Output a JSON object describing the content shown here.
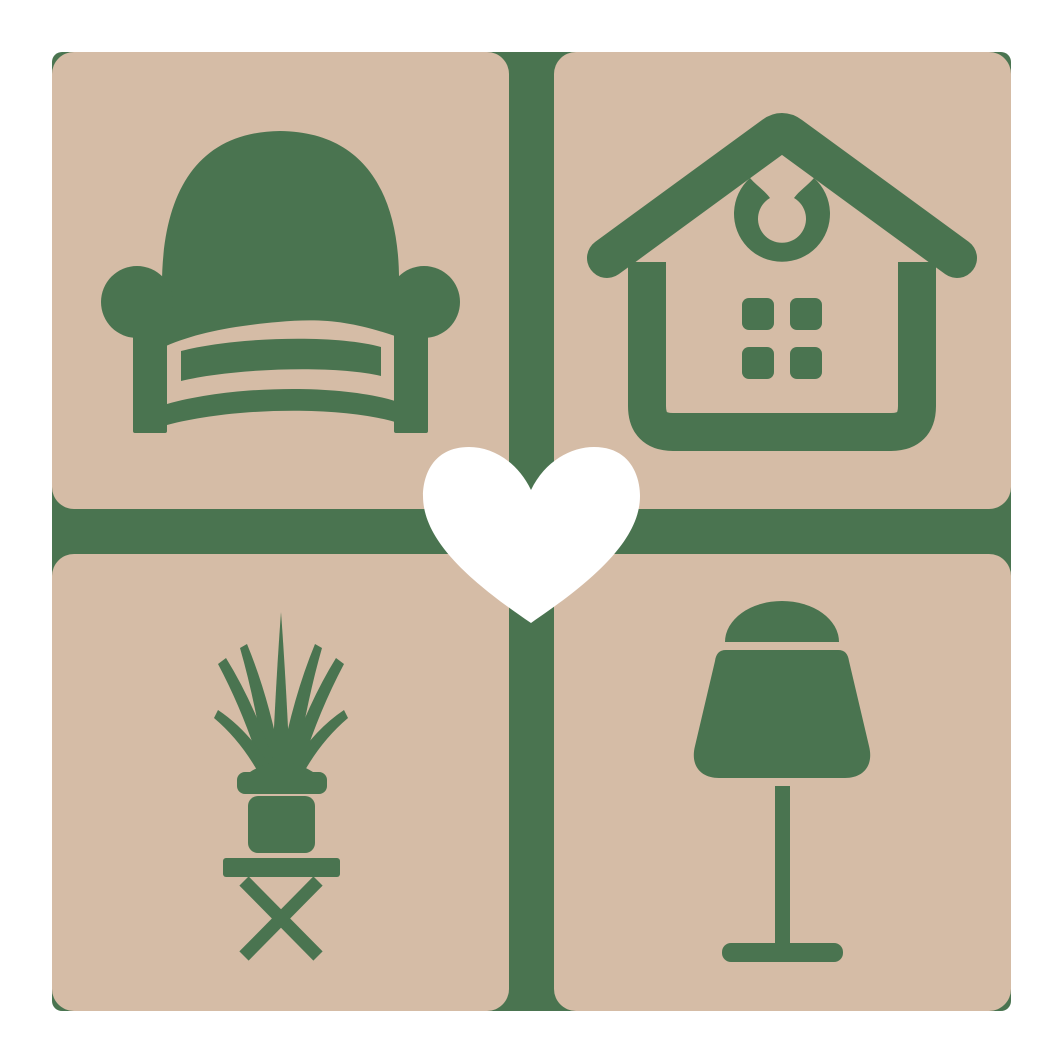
{
  "logo": {
    "name": "home-decor-heart-logo",
    "colors": {
      "background": "#ffffff",
      "tile": "#d5bca6",
      "green": "#4a7450",
      "heart": "#ffffff"
    },
    "tiles": [
      {
        "position": "top-left",
        "icon": "armchair-icon"
      },
      {
        "position": "top-right",
        "icon": "house-icon"
      },
      {
        "position": "bottom-left",
        "icon": "potted-plant-icon"
      },
      {
        "position": "bottom-right",
        "icon": "table-lamp-icon"
      }
    ],
    "center": {
      "icon": "heart-icon"
    }
  }
}
